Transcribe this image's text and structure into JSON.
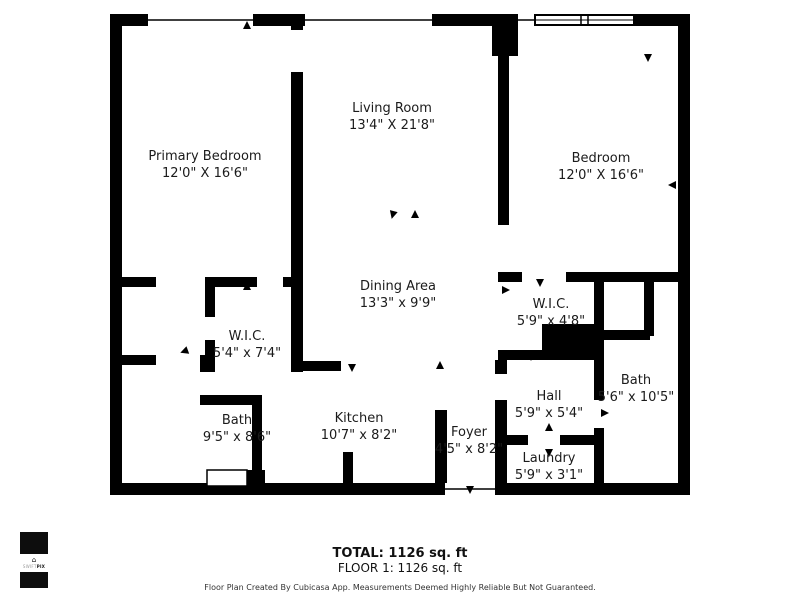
{
  "rooms": [
    {
      "id": "primary-bedroom",
      "name": "Primary Bedroom",
      "dims": "12'0\" X 16'6\""
    },
    {
      "id": "living-room",
      "name": "Living Room",
      "dims": "13'4\" X 21'8\""
    },
    {
      "id": "bedroom",
      "name": "Bedroom",
      "dims": "12'0\" X 16'6\""
    },
    {
      "id": "dining-area",
      "name": "Dining Area",
      "dims": "13'3\" x 9'9\""
    },
    {
      "id": "wic-left",
      "name": "W.I.C.",
      "dims": "5'4\" x 7'4\""
    },
    {
      "id": "wic-right",
      "name": "W.I.C.",
      "dims": "5'9\" x 4'8\""
    },
    {
      "id": "bath-left",
      "name": "Bath",
      "dims": "9'5\" x 8'6\""
    },
    {
      "id": "kitchen",
      "name": "Kitchen",
      "dims": "10'7\" x 8'2\""
    },
    {
      "id": "foyer",
      "name": "Foyer",
      "dims": "4'5\" x 8'2\""
    },
    {
      "id": "hall",
      "name": "Hall",
      "dims": "5'9\" x 5'4\""
    },
    {
      "id": "bath-right",
      "name": "Bath",
      "dims": "5'6\" x 10'5\""
    },
    {
      "id": "laundry",
      "name": "Laundry",
      "dims": "5'9\" x 3'1\""
    }
  ],
  "footer": {
    "total": "TOTAL: 1126 sq. ft",
    "floor": "FLOOR 1: 1126 sq. ft",
    "disclaimer": "Floor Plan Created By Cubicasa App. Measurements Deemed Highly Reliable But Not Guaranteed."
  },
  "logo": {
    "brand": "SWIFTPIX",
    "brand_prefix": "SWIFT",
    "brand_suffix": "PIX",
    "house_glyph": "⌂"
  },
  "colors": {
    "wall": "#000000",
    "background": "#ffffff",
    "text": "#1b1b1b"
  }
}
